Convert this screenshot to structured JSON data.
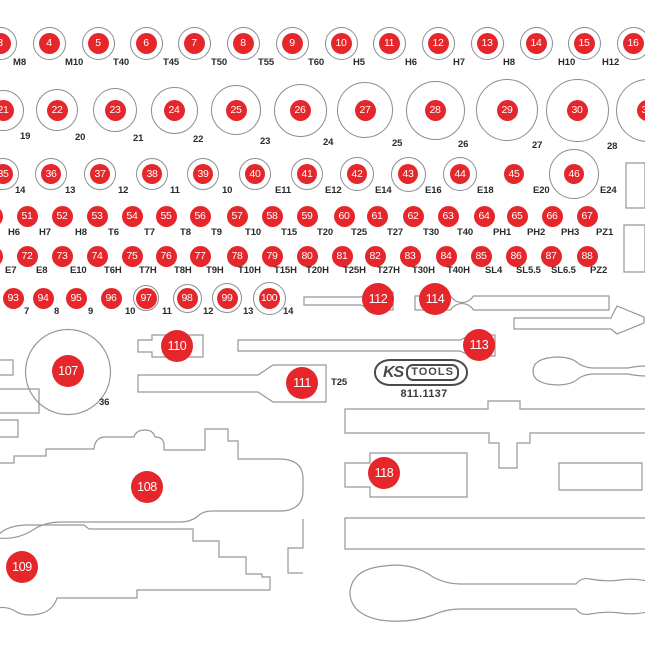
{
  "brand": {
    "name_ks": "KS",
    "name_tools": "TOOLS",
    "part_number": "811.1137"
  },
  "colors": {
    "marker_red": "#e5262b",
    "outline_gray": "#979797",
    "ring_gray": "#8d8d8d",
    "label_color": "#2b2b2b"
  },
  "rows": [
    {
      "name": "sockets-row-1",
      "y": 43,
      "ring_r": 16.5,
      "red_r": 10.5,
      "label_y": 57,
      "items": [
        {
          "n": 3,
          "x": 0,
          "label": "M8",
          "lx": 13
        },
        {
          "n": 4,
          "x": 49,
          "label": "M10",
          "lx": 65
        },
        {
          "n": 5,
          "x": 98,
          "label": "T40",
          "lx": 113
        },
        {
          "n": 6,
          "x": 146,
          "label": "T45",
          "lx": 163
        },
        {
          "n": 7,
          "x": 194,
          "label": "T50",
          "lx": 211
        },
        {
          "n": 8,
          "x": 243,
          "label": "T55",
          "lx": 258
        },
        {
          "n": 9,
          "x": 292,
          "label": "T60",
          "lx": 308
        },
        {
          "n": 10,
          "x": 341,
          "label": "H5",
          "lx": 353
        },
        {
          "n": 11,
          "x": 389,
          "label": "H6",
          "lx": 405
        },
        {
          "n": 12,
          "x": 438,
          "label": "H7",
          "lx": 453
        },
        {
          "n": 13,
          "x": 487,
          "label": "H8",
          "lx": 503
        },
        {
          "n": 14,
          "x": 536,
          "label": "H10",
          "lx": 558
        },
        {
          "n": 15,
          "x": 584,
          "label": "H12",
          "lx": 602
        },
        {
          "n": 16,
          "x": 633
        }
      ]
    },
    {
      "name": "sockets-row-2",
      "y": 110,
      "ring_r": 21,
      "red_r": 10.5,
      "label_y": 131,
      "items": [
        {
          "n": 21,
          "x": 3,
          "r": 20.5,
          "label": "19",
          "lx": 20,
          "ly": 131
        },
        {
          "n": 22,
          "x": 57,
          "r": 21,
          "label": "20",
          "lx": 75,
          "ly": 132
        },
        {
          "n": 23,
          "x": 115,
          "r": 22,
          "label": "21",
          "lx": 133,
          "ly": 133
        },
        {
          "n": 24,
          "x": 174,
          "r": 23.5,
          "label": "22",
          "lx": 193,
          "ly": 134
        },
        {
          "n": 25,
          "x": 236,
          "r": 25,
          "label": "23",
          "lx": 260,
          "ly": 136
        },
        {
          "n": 26,
          "x": 300,
          "r": 26.5,
          "label": "24",
          "lx": 323,
          "ly": 137
        },
        {
          "n": 27,
          "x": 365,
          "r": 28,
          "label": "25",
          "lx": 392,
          "ly": 138
        },
        {
          "n": 28,
          "x": 435,
          "r": 29.5,
          "label": "26",
          "lx": 458,
          "ly": 139
        },
        {
          "n": 29,
          "x": 507,
          "r": 31,
          "label": "27",
          "lx": 532,
          "ly": 140
        },
        {
          "n": 30,
          "x": 577,
          "r": 31.5,
          "label": "28",
          "lx": 607,
          "ly": 141
        },
        {
          "n": 31,
          "x": 647,
          "r": 31.5
        }
      ]
    },
    {
      "name": "sockets-row-3",
      "y": 174,
      "ring_r": 16,
      "red_r": 10,
      "label_y": 185,
      "items": [
        {
          "n": 35,
          "x": 3,
          "label": "14",
          "lx": 15
        },
        {
          "n": 36,
          "x": 51,
          "label": "13",
          "lx": 65
        },
        {
          "n": 37,
          "x": 100,
          "label": "12",
          "lx": 118
        },
        {
          "n": 38,
          "x": 152,
          "label": "11",
          "lx": 170
        },
        {
          "n": 39,
          "x": 203,
          "label": "10",
          "lx": 222
        },
        {
          "n": 40,
          "x": 255,
          "label": "E11",
          "lx": 275
        },
        {
          "n": 41,
          "x": 307,
          "label": "E12",
          "lx": 325
        },
        {
          "n": 42,
          "x": 357,
          "r": 17,
          "label": "E14",
          "lx": 375
        },
        {
          "n": 43,
          "x": 408,
          "r": 17.5,
          "label": "E16",
          "lx": 425
        },
        {
          "n": 44,
          "x": 460,
          "r": 17,
          "label": "E18",
          "lx": 477
        },
        {
          "n": 45,
          "x": 514,
          "r": 0,
          "label": "E20",
          "lx": 533
        },
        {
          "n": 46,
          "x": 574,
          "r": 25,
          "label": "E24",
          "lx": 600
        }
      ]
    },
    {
      "name": "bits-row-4",
      "y": 216,
      "ring_r": 0,
      "red_r": 10.5,
      "label_y": 227,
      "items": [
        {
          "n": 50,
          "x": -8
        },
        {
          "n": 51,
          "x": 27,
          "label": "H6",
          "lx": 8
        },
        {
          "n": 52,
          "x": 62,
          "label": "H7",
          "lx": 39
        },
        {
          "n": 53,
          "x": 97,
          "label": "H8",
          "lx": 75
        },
        {
          "n": 54,
          "x": 132,
          "label": "T6",
          "lx": 108
        },
        {
          "n": 55,
          "x": 166,
          "label": "T7",
          "lx": 144
        },
        {
          "n": 56,
          "x": 200,
          "label": "T8",
          "lx": 180
        },
        {
          "n": 57,
          "x": 237,
          "label": "T9",
          "lx": 211
        },
        {
          "n": 58,
          "x": 272,
          "label": "T10",
          "lx": 245
        },
        {
          "n": 59,
          "x": 307,
          "label": "T15",
          "lx": 281
        },
        {
          "n": 60,
          "x": 344,
          "label": "T20",
          "lx": 317
        },
        {
          "n": 61,
          "x": 377,
          "label": "T25",
          "lx": 351
        },
        {
          "n": 62,
          "x": 413,
          "label": "T27",
          "lx": 387
        },
        {
          "n": 63,
          "x": 448,
          "label": "T30",
          "lx": 423
        },
        {
          "n": 64,
          "x": 484,
          "label": "T40",
          "lx": 457
        },
        {
          "n": 65,
          "x": 517,
          "label": "PH1",
          "lx": 493
        },
        {
          "n": 66,
          "x": 552,
          "label": "PH2",
          "lx": 527
        },
        {
          "n": 67,
          "x": 587,
          "label": "PH3",
          "lx": 561
        },
        {
          "label": "PZ1",
          "lx": 596
        }
      ]
    },
    {
      "name": "bits-row-5",
      "y": 256,
      "ring_r": 0,
      "red_r": 10.5,
      "label_y": 265,
      "items": [
        {
          "n": 71,
          "x": -8
        },
        {
          "n": 72,
          "x": 27,
          "label": "E7",
          "lx": 5
        },
        {
          "n": 73,
          "x": 62,
          "label": "E8",
          "lx": 36
        },
        {
          "n": 74,
          "x": 97,
          "label": "E10",
          "lx": 70
        },
        {
          "n": 75,
          "x": 132,
          "label": "T6H",
          "lx": 104
        },
        {
          "n": 76,
          "x": 166,
          "label": "T7H",
          "lx": 139
        },
        {
          "n": 77,
          "x": 200,
          "label": "T8H",
          "lx": 174
        },
        {
          "n": 78,
          "x": 237,
          "label": "T9H",
          "lx": 206
        },
        {
          "n": 79,
          "x": 272,
          "label": "T10H",
          "lx": 238
        },
        {
          "n": 80,
          "x": 307,
          "label": "T15H",
          "lx": 274
        },
        {
          "n": 81,
          "x": 342,
          "label": "T20H",
          "lx": 306
        },
        {
          "n": 82,
          "x": 375,
          "label": "T25H",
          "lx": 343
        },
        {
          "n": 83,
          "x": 410,
          "label": "T27H",
          "lx": 377
        },
        {
          "n": 84,
          "x": 446,
          "label": "T30H",
          "lx": 412
        },
        {
          "n": 85,
          "x": 481,
          "label": "T40H",
          "lx": 447
        },
        {
          "n": 86,
          "x": 516,
          "label": "SL4",
          "lx": 485
        },
        {
          "n": 87,
          "x": 551,
          "label": "SL5.5",
          "lx": 516
        },
        {
          "n": 88,
          "x": 587,
          "label": "SL6.5",
          "lx": 551
        },
        {
          "label": "PZ2",
          "lx": 590
        }
      ]
    },
    {
      "name": "drive-row-6",
      "y": 298,
      "ring_r": 0,
      "red_r": 10.5,
      "label_y": 306,
      "items": [
        {
          "n": 93,
          "x": 13,
          "label": "7",
          "lx": 24
        },
        {
          "n": 94,
          "x": 43,
          "label": "8",
          "lx": 54
        },
        {
          "n": 95,
          "x": 76,
          "label": "9",
          "lx": 88
        },
        {
          "n": 96,
          "x": 111,
          "label": "10",
          "lx": 125
        },
        {
          "n": 97,
          "x": 146,
          "r": 13,
          "label": "11",
          "lx": 162
        },
        {
          "n": 98,
          "x": 187,
          "r": 14.5,
          "label": "12",
          "lx": 203
        },
        {
          "n": 99,
          "x": 227,
          "r": 15,
          "label": "13",
          "lx": 243
        },
        {
          "n": 100,
          "x": 269,
          "r": 16.5,
          "label": "14",
          "lx": 283
        }
      ]
    }
  ],
  "badges": [
    {
      "n": 107,
      "x": 68,
      "y": 371
    },
    {
      "n": 108,
      "x": 147,
      "y": 487
    },
    {
      "n": 109,
      "x": 22,
      "y": 567
    },
    {
      "n": 110,
      "x": 177,
      "y": 346
    },
    {
      "n": 111,
      "x": 302,
      "y": 383
    },
    {
      "n": 112,
      "x": 378,
      "y": 299
    },
    {
      "n": 113,
      "x": 479,
      "y": 345
    },
    {
      "n": 114,
      "x": 435,
      "y": 299
    },
    {
      "n": 118,
      "x": 384,
      "y": 473
    }
  ],
  "floating_labels": [
    {
      "text": "36",
      "x": 99,
      "y": 397
    },
    {
      "text": "T25",
      "x": 331,
      "y": 377
    }
  ]
}
